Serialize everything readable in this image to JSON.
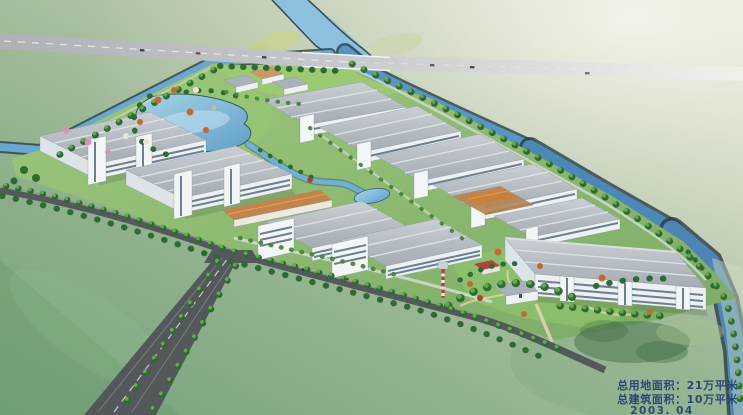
{
  "annotation": {
    "land_area_label": "总用地面积：21万平米",
    "built_area_label": "总建筑面积：10万平米",
    "date_label": "2003. 04",
    "text_color": "#223e77"
  },
  "palette": {
    "field_pale": "#e9eedd",
    "field_mid": "#a9bda1",
    "field_green": "#7ba57e",
    "field_deep": "#659668",
    "highway_gray": "#b2b4ba",
    "road_dark": "#53585a",
    "water_light": "#9fd0ea",
    "water_mid": "#66a4cf",
    "water_deep": "#4d86b4",
    "bank_dark": "#2b3d42",
    "roof_light": "#c3c9ce",
    "roof_mid": "#aab1b8",
    "facade_white": "#edf1f3",
    "window_blue": "#5f7486",
    "tan_roof": "#c28448",
    "lawn_green": "#9ccb72",
    "tree_dark": "#2d6b33",
    "tree_mid": "#47853b",
    "tree_light": "#6fae4e",
    "accent_orange": "#c06a30",
    "accent_pink": "#d795b5"
  },
  "features": [
    "highway-bridge",
    "river",
    "northwest-boundary-canal",
    "northeast-boundary-canal",
    "industrial-site",
    "lake",
    "landscape-stream",
    "warehouse-rows",
    "office-blocks",
    "tan-roof-building",
    "staging-yard",
    "gatehouse",
    "water-tower",
    "entrance-garden",
    "approach-road",
    "boundary-road",
    "tree-rows",
    "farm-fields"
  ]
}
